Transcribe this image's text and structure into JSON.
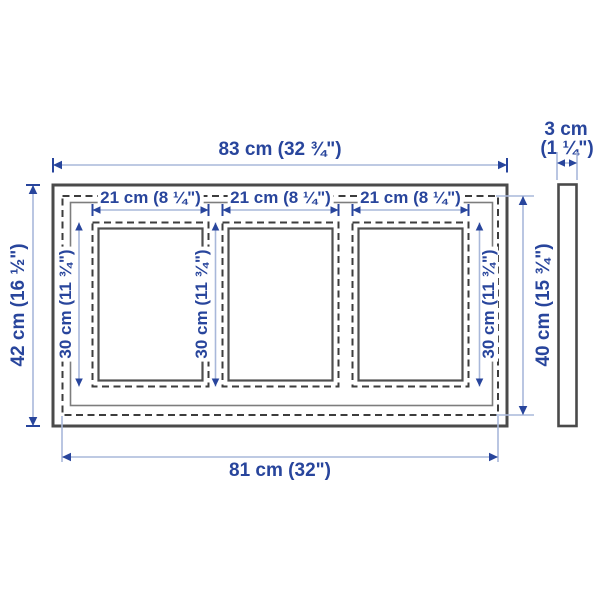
{
  "diagram": {
    "description": "Picture frame dimension diagram with three openings, front view and side profile view"
  },
  "dimensions": {
    "overall_width": "83 cm (32 ¾\")",
    "overall_height": "42 cm (16 ½\")",
    "back_width": "81 cm (32\")",
    "back_height": "40 cm (15 ¾\")",
    "depth_cm": "3 cm",
    "depth_in": "(1 ¼\")",
    "opening_width": "21 cm (8 ¼\")",
    "opening_height": "30 cm (11 ¾\")"
  },
  "colors": {
    "dimension_text": "#28459c",
    "dimension_line": "#a9b8da",
    "arrowhead": "#28459c",
    "frame_outline": "#4a4a4a",
    "dashed_outline": "#3d3d3d",
    "background": "#ffffff"
  }
}
